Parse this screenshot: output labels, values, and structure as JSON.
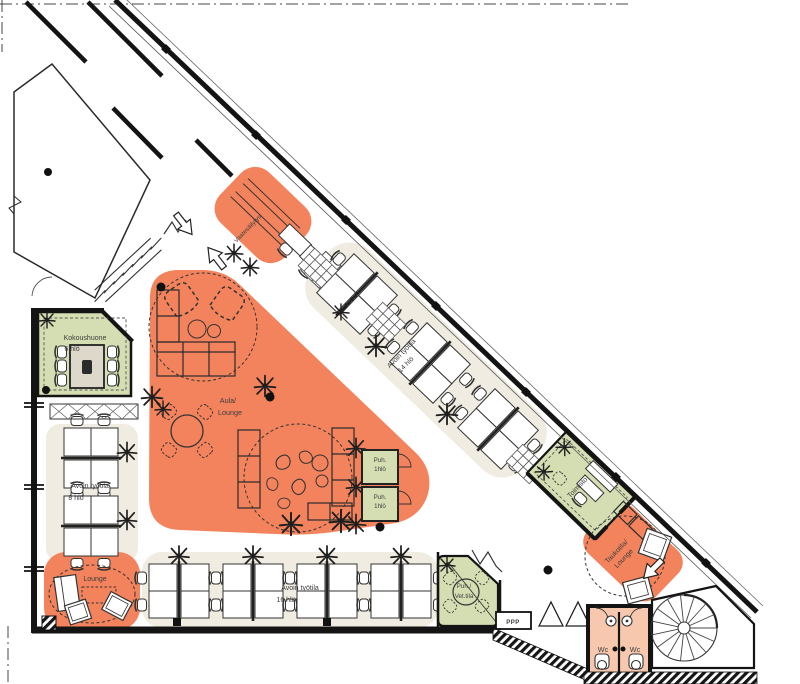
{
  "meta": {
    "title": "Office floor plan"
  },
  "colors": {
    "orange": "#F2835D",
    "orange_light": "#F7C8AE",
    "green": "#D4DEB2",
    "beige": "#F1ECE1",
    "wall": "#141414",
    "ink": "#333333"
  },
  "rooms": {
    "vaatesailytys": {
      "label": "Vaatesäilytys"
    },
    "aula": {
      "line1": "Aula/",
      "line2": "Lounge"
    },
    "avoin14": {
      "line1": "Avoin työtila",
      "line2": "14 hlö"
    },
    "kokoushuone": {
      "line1": "Kokoushuone",
      "line2": "6 hlö"
    },
    "avoin8": {
      "line1": "Avoin työtila",
      "line2": "8 hlö"
    },
    "lounge": {
      "label": "Lounge"
    },
    "avoin16": {
      "line1": "Avoin työtila",
      "line2": "16 hlö"
    },
    "puh1": {
      "line1": "Puh.",
      "line2": "1hlö"
    },
    "puh2": {
      "line1": "Puh.",
      "line2": "1hlö"
    },
    "vet": {
      "line1": "Puh./",
      "line2": "Vet.tila"
    },
    "toimisto": {
      "label": "Toimisto"
    },
    "taukotila": {
      "line1": "Taukotila/",
      "line2": "Lounge"
    },
    "wc_left": {
      "label": "Wc"
    },
    "wc_right": {
      "label": "Wc"
    },
    "ppp": {
      "label": "PPP"
    }
  }
}
